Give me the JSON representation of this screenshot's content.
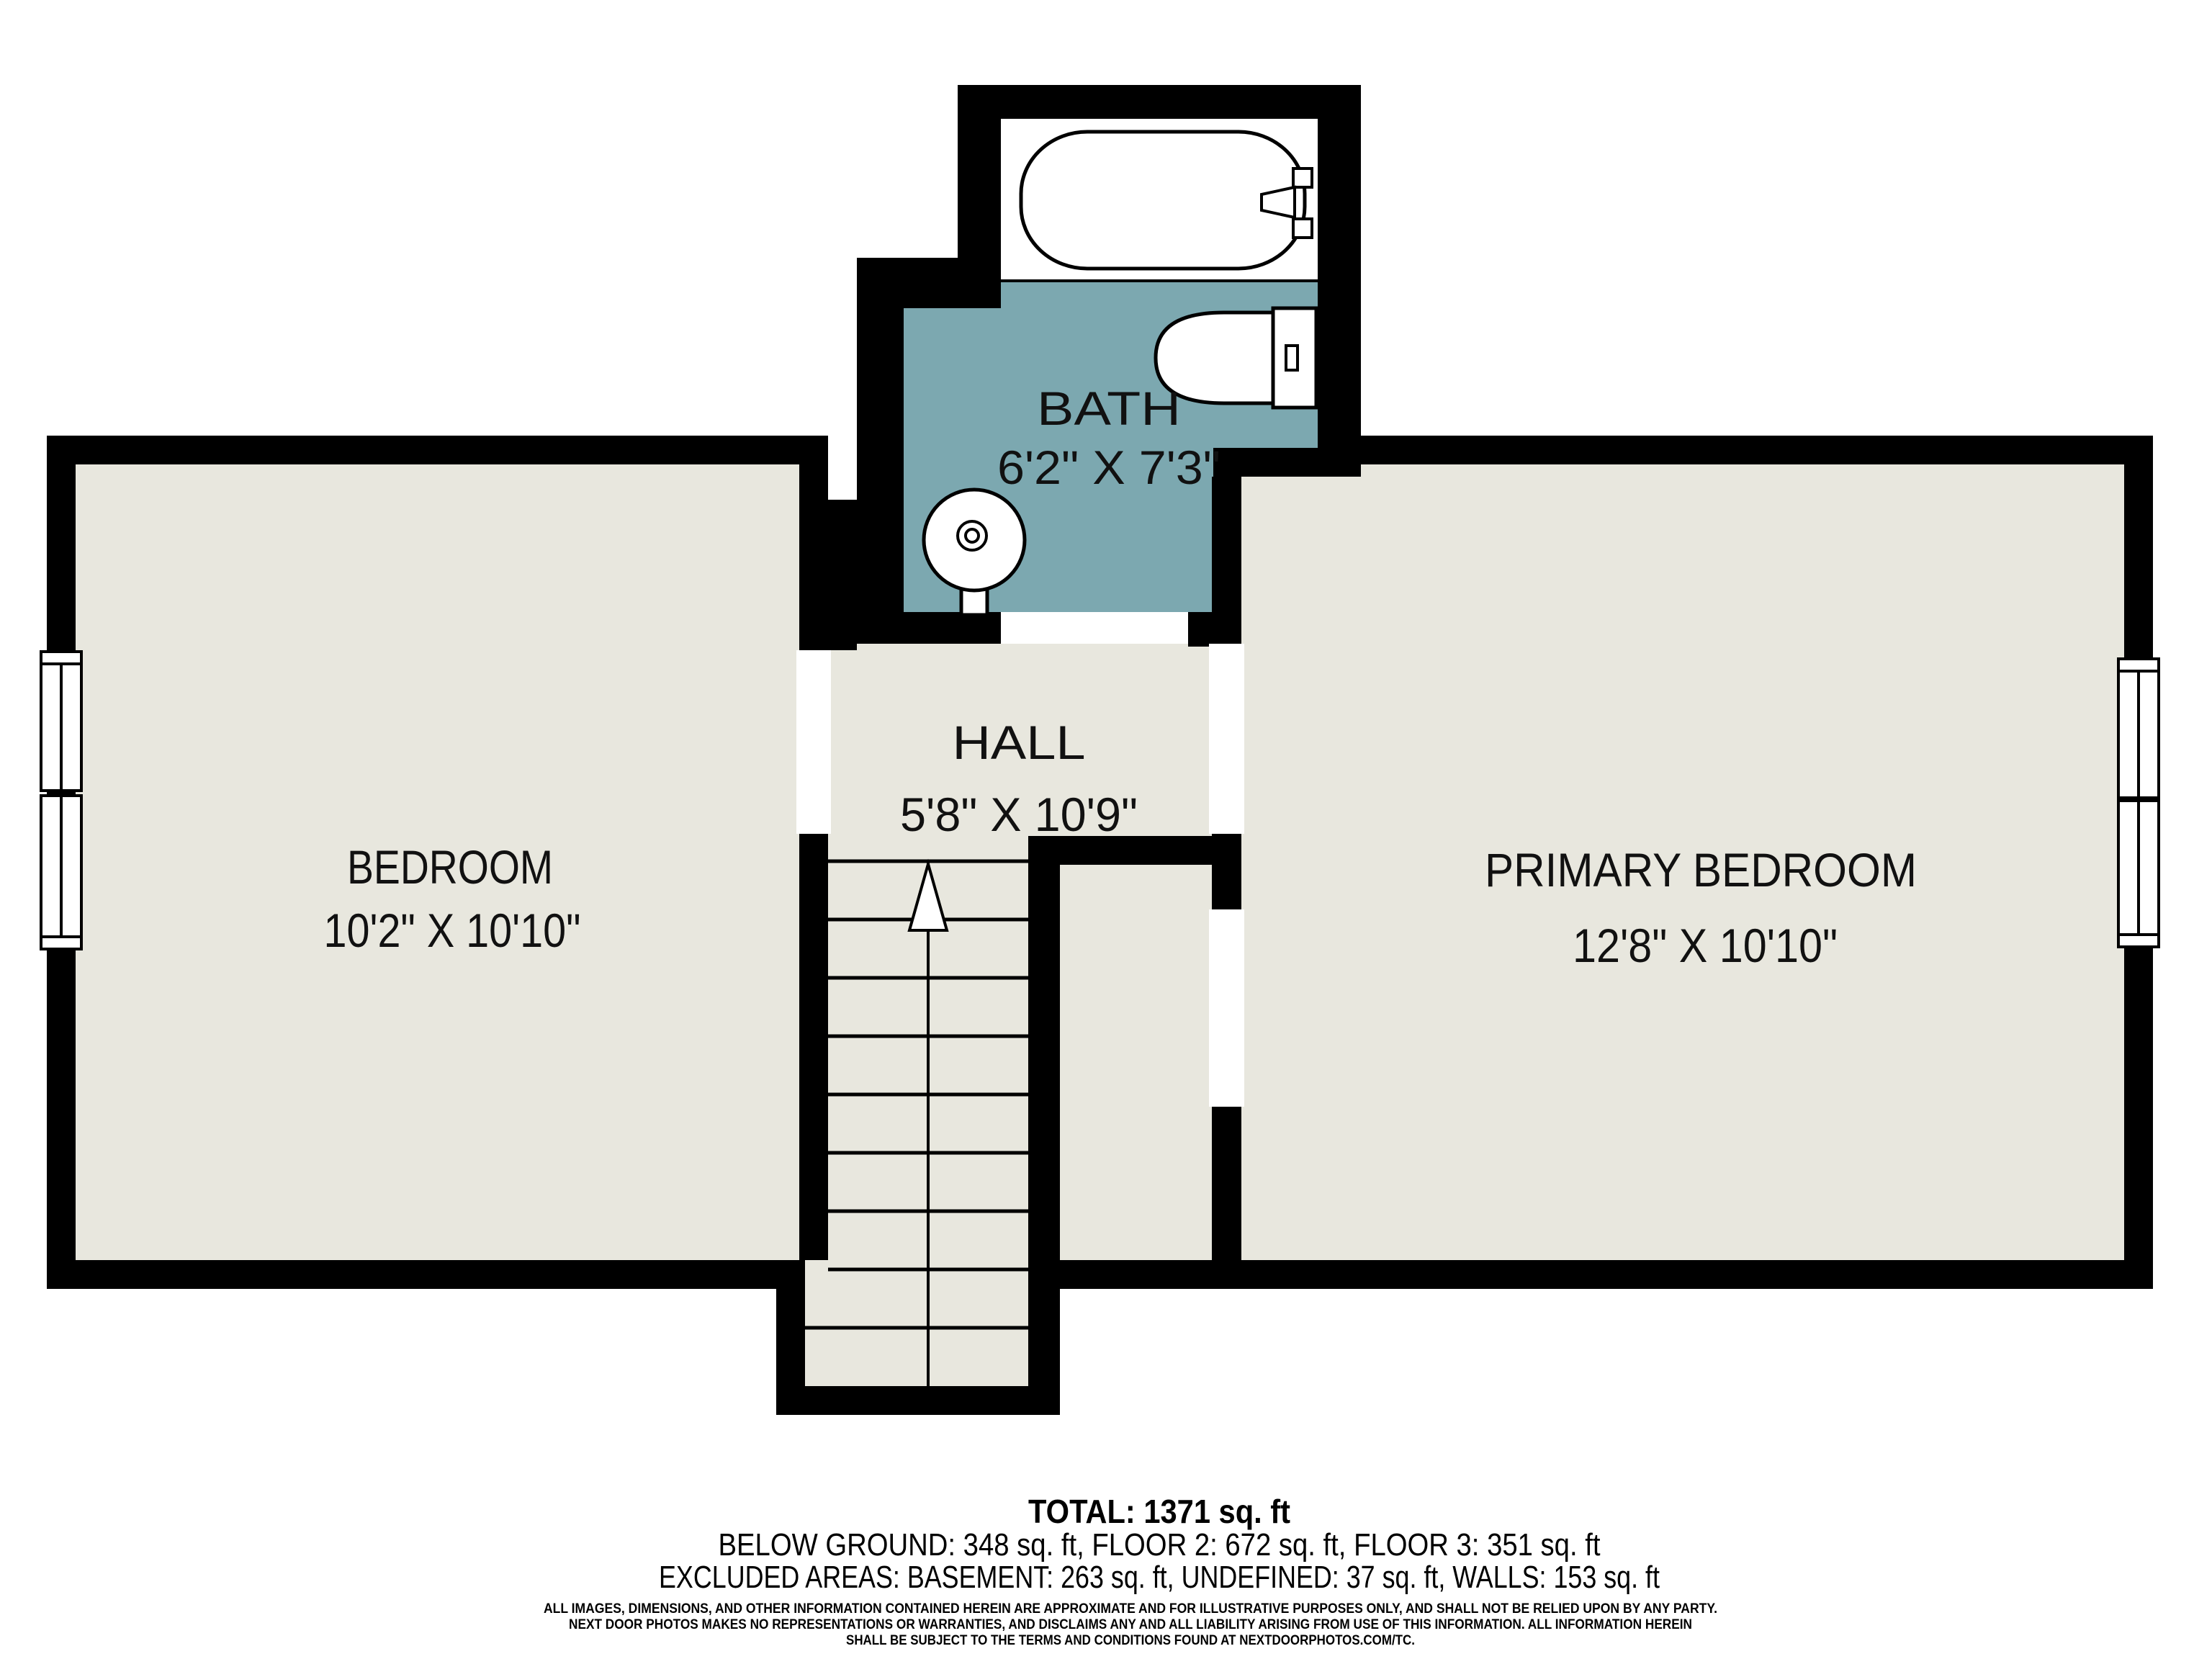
{
  "colors": {
    "background": "#ffffff",
    "wall": "#000000",
    "floor": "#e8e7de",
    "bath_floor": "#7ca8b0",
    "text": "#111111"
  },
  "rooms": {
    "bath": {
      "label": "BATH",
      "dims": "6'2\" X 7'3\""
    },
    "hall": {
      "label": "HALL",
      "dims": "5'8\" X 10'9\""
    },
    "bedroom": {
      "label": "BEDROOM",
      "dims": "10'2\" X 10'10\""
    },
    "primary_bedroom": {
      "label": "PRIMARY BEDROOM",
      "dims": "12'8\" X 10'10\""
    }
  },
  "fixtures": {
    "bathtub": "bathtub-icon",
    "toilet": "toilet-icon",
    "sink": "sink-icon",
    "stairs_arrow": "up-arrow-icon",
    "windows": "window-icon"
  },
  "footer": {
    "total": "TOTAL: 1371 sq. ft",
    "floors": "BELOW GROUND: 348 sq. ft, FLOOR 2: 672 sq. ft, FLOOR 3: 351 sq. ft",
    "excluded": "EXCLUDED AREAS: BASEMENT: 263 sq. ft, UNDEFINED: 37 sq. ft, WALLS: 153 sq. ft",
    "disclaimer": [
      "ALL IMAGES, DIMENSIONS, AND OTHER INFORMATION CONTAINED HEREIN ARE APPROXIMATE AND FOR ILLUSTRATIVE PURPOSES ONLY, AND SHALL NOT BE RELIED UPON BY ANY PARTY.",
      "NEXT DOOR PHOTOS MAKES NO REPRESENTATIONS OR WARRANTIES, AND DISCLAIMS ANY AND ALL LIABILITY ARISING FROM USE OF THIS INFORMATION. ALL INFORMATION HEREIN",
      "SHALL BE SUBJECT TO THE TERMS AND CONDITIONS FOUND AT NEXTDOORPHOTOS.COM/TC."
    ]
  }
}
